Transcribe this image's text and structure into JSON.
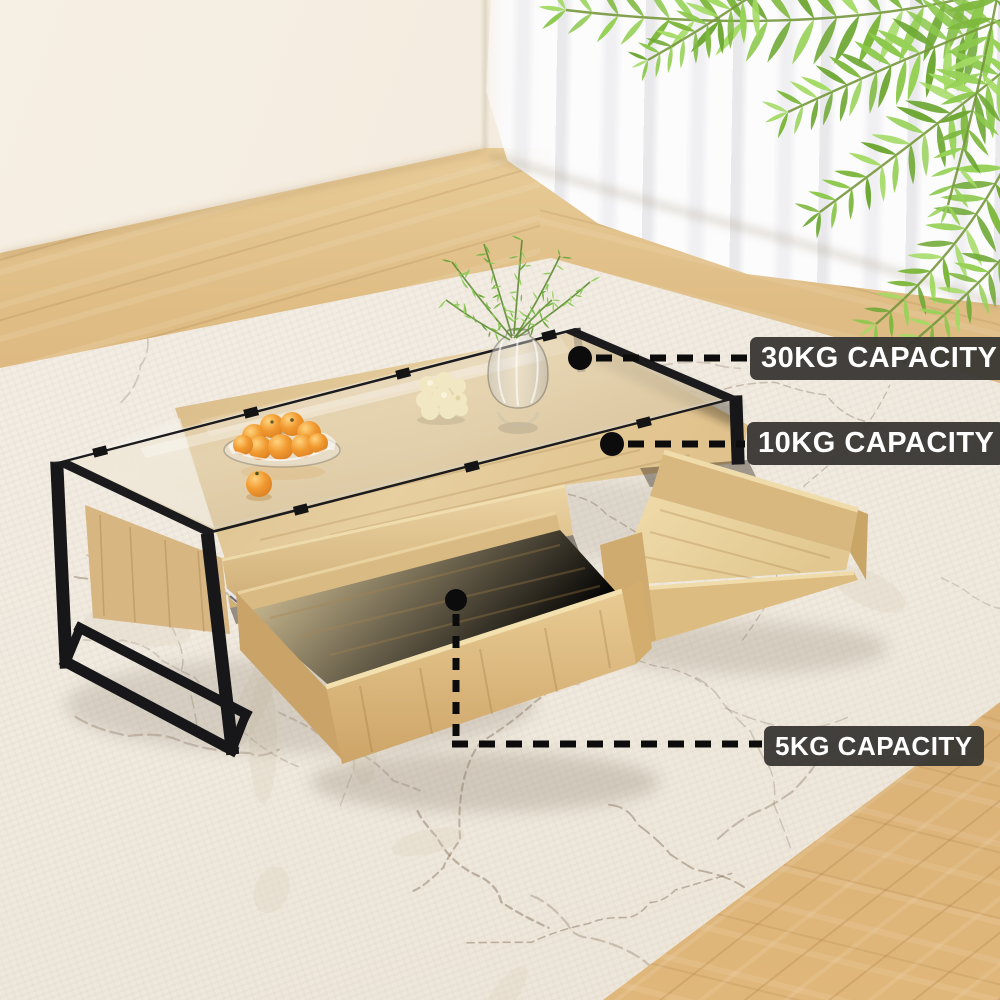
{
  "annotations": {
    "glass_top": {
      "marker": "callout-dot",
      "label": "30KG CAPACITY"
    },
    "middle_shelf": {
      "marker": "callout-dot",
      "label": "10KG CAPACITY"
    },
    "drawer": {
      "marker": "callout-dot",
      "label": "5KG CAPACITY"
    }
  },
  "colors": {
    "label_background": "#383633",
    "label_text": "#ffffff",
    "callout_line": "#0c0c0c",
    "metal_frame": "#1a1a1c",
    "wood_light": "#e6c992",
    "wood_floor": "#d9b27b",
    "rug": "#f1ebe1",
    "wall": "#f4ede1",
    "curtain": "#fcfcfd",
    "leaf_green": "#85c04a",
    "orange_fruit": "#ef9a30"
  }
}
